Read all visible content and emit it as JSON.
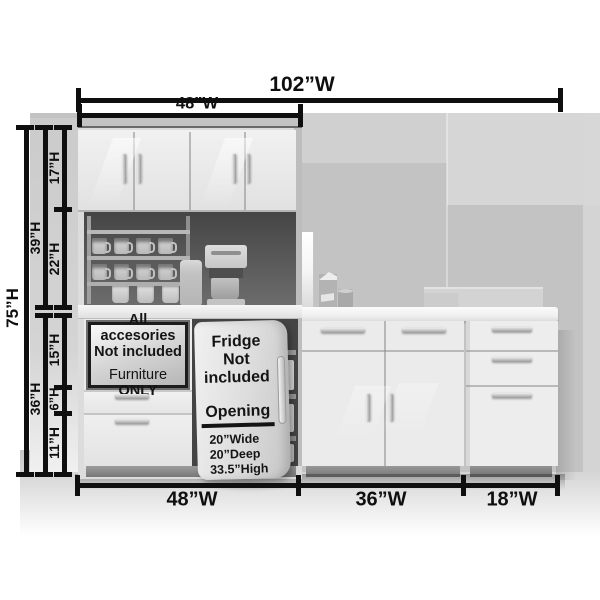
{
  "palette": {
    "dimension_color": "#0f0f0f",
    "cabinet_white": "#ececec",
    "wall_gray": "#c4c4c4",
    "interior_dark": "#474747"
  },
  "dimensions": {
    "top": {
      "overall": "102”W",
      "hutch": "48”W"
    },
    "left": {
      "overall": "75”H",
      "upper": "39”H",
      "cabinet": "17”H",
      "shelf": "22”H",
      "lower": "36”H",
      "sign": "15”H",
      "drawer_small": "6”H",
      "drawer_large": "11”H"
    },
    "bottom": {
      "hutch": "48”W",
      "base": "36”W",
      "drawers": "18”W"
    }
  },
  "sign": {
    "line1": "All accesories",
    "line2": "Not included",
    "line3_text": "Furniture",
    "line3_emphasis": "ONLY"
  },
  "fridge_door": {
    "note_line1": "Fridge Not",
    "note_line2": "included",
    "heading": "Opening",
    "specs": [
      "20”Wide",
      "20”Deep",
      "33.5”High"
    ]
  }
}
